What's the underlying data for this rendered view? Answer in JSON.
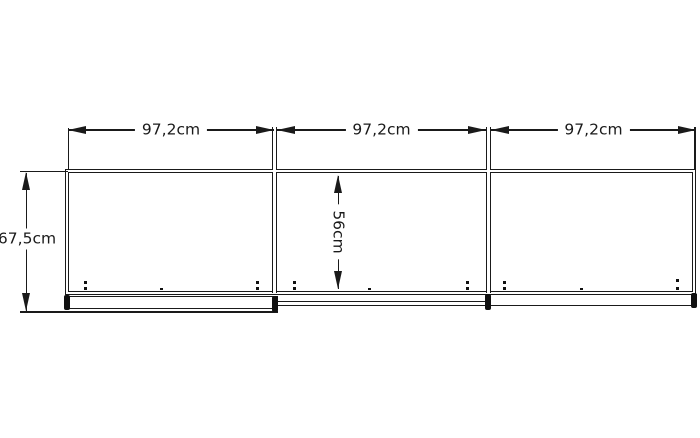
{
  "diagram": {
    "kind": "furniture dimension drawing",
    "background_color": "#ffffff",
    "line_color": "#1a1a1a",
    "width_dimensions": [
      "97,2cm",
      "97,2cm",
      "97,2cm"
    ],
    "overall_height_dimension": "67,5cm",
    "inner_height_dimension": "56cm"
  }
}
